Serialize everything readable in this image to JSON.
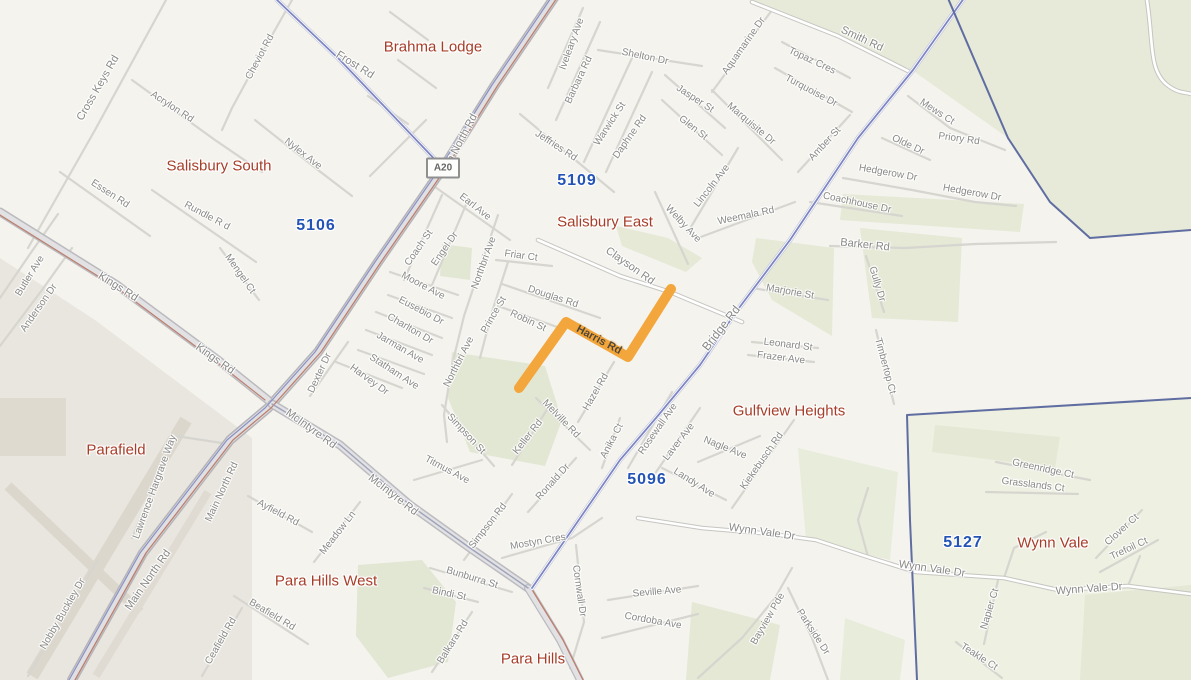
{
  "map": {
    "road_shield": {
      "label": "A20"
    },
    "route_highlight": {
      "name": "Harris Rd",
      "color": "#F3A63B"
    },
    "colors": {
      "background_urban": "#f4f3ee",
      "terrain_green": "#e7ead9",
      "airport_grey": "#e9e6df",
      "arterial_blue": "#7d86c2",
      "boundary_navy": "#5f6da1",
      "suburb_text": "#a63d28",
      "postcode_text": "#2353b5",
      "street_text": "#898987"
    },
    "suburb_labels": [
      {
        "t": "Brahma Lodge",
        "x": 433,
        "y": 47
      },
      {
        "t": "Salisbury South",
        "x": 219,
        "y": 166
      },
      {
        "t": "Salisbury East",
        "x": 605,
        "y": 222
      },
      {
        "t": "Parafield",
        "x": 116,
        "y": 450
      },
      {
        "t": "Para Hills West",
        "x": 326,
        "y": 581
      },
      {
        "t": "Para Hills",
        "x": 533,
        "y": 659
      },
      {
        "t": "Gulfview Heights",
        "x": 789,
        "y": 411
      },
      {
        "t": "Wynn Vale",
        "x": 1053,
        "y": 543
      }
    ],
    "postcode_labels": [
      {
        "t": "5106",
        "x": 316,
        "y": 226
      },
      {
        "t": "5109",
        "x": 577,
        "y": 181
      },
      {
        "t": "5096",
        "x": 647,
        "y": 480
      },
      {
        "t": "5127",
        "x": 963,
        "y": 543
      }
    ],
    "street_labels": [
      {
        "t": "Cross Keys Rd",
        "x": 98,
        "y": 88,
        "r": -60,
        "s": 11
      },
      {
        "t": "Acrylon Rd",
        "x": 172,
        "y": 107,
        "r": 33
      },
      {
        "t": "Cheviot Rd",
        "x": 260,
        "y": 57,
        "r": -62
      },
      {
        "t": "Frost Rd",
        "x": 355,
        "y": 65,
        "r": 32,
        "s": 11
      },
      {
        "t": "Nylex Ave",
        "x": 303,
        "y": 154,
        "r": 38
      },
      {
        "t": "Essen Rd",
        "x": 110,
        "y": 194,
        "r": 33
      },
      {
        "t": "Rundle R d",
        "x": 207,
        "y": 216,
        "r": 28
      },
      {
        "t": "Butler Ave",
        "x": 30,
        "y": 276,
        "r": -58
      },
      {
        "t": "Anderson Dr",
        "x": 39,
        "y": 308,
        "r": -55
      },
      {
        "t": "Kings Rd",
        "x": 118,
        "y": 287,
        "r": 32,
        "s": 11
      },
      {
        "t": "Kings Rd",
        "x": 215,
        "y": 359,
        "r": 35,
        "s": 11
      },
      {
        "t": "Mengel Ct",
        "x": 240,
        "y": 274,
        "r": 55
      },
      {
        "t": "Main North Rd",
        "x": 458,
        "y": 146,
        "r": -62,
        "s": 11
      },
      {
        "t": "Main North Rd",
        "x": 222,
        "y": 492,
        "r": -65
      },
      {
        "t": "Main North Rd",
        "x": 148,
        "y": 580,
        "r": -55,
        "s": 11
      },
      {
        "t": "Iveleary Ave",
        "x": 572,
        "y": 44,
        "r": -70
      },
      {
        "t": "Barbara Rd",
        "x": 579,
        "y": 80,
        "r": -65
      },
      {
        "t": "Jeffries Rd",
        "x": 556,
        "y": 146,
        "r": 33
      },
      {
        "t": "Warwick St",
        "x": 610,
        "y": 124,
        "r": -57
      },
      {
        "t": "Daphne Rd",
        "x": 630,
        "y": 137,
        "r": -55
      },
      {
        "t": "Shelton Dr",
        "x": 645,
        "y": 57,
        "r": 12
      },
      {
        "t": "Jasper St",
        "x": 695,
        "y": 99,
        "r": 33
      },
      {
        "t": "Glen St",
        "x": 693,
        "y": 128,
        "r": 38
      },
      {
        "t": "Aquamarine Dr",
        "x": 744,
        "y": 46,
        "r": -55
      },
      {
        "t": "Topaz Cres",
        "x": 812,
        "y": 61,
        "r": 25
      },
      {
        "t": "Turquoise Dr",
        "x": 811,
        "y": 91,
        "r": 28
      },
      {
        "t": "Marquisite Dr",
        "x": 751,
        "y": 124,
        "r": 40
      },
      {
        "t": "Amber St",
        "x": 825,
        "y": 144,
        "r": -47
      },
      {
        "t": "Lincoln Ave",
        "x": 712,
        "y": 186,
        "r": -52
      },
      {
        "t": "Welby Ave",
        "x": 683,
        "y": 224,
        "r": 47
      },
      {
        "t": "Weemala Rd",
        "x": 746,
        "y": 216,
        "r": -12
      },
      {
        "t": "Smith Rd",
        "x": 862,
        "y": 39,
        "r": 25,
        "s": 11
      },
      {
        "t": "Mews Ct",
        "x": 937,
        "y": 112,
        "r": 33
      },
      {
        "t": "Priory Rd",
        "x": 959,
        "y": 139,
        "r": 8
      },
      {
        "t": "Olde Dr",
        "x": 908,
        "y": 145,
        "r": 25
      },
      {
        "t": "Hedgerow Dr",
        "x": 888,
        "y": 173,
        "r": 10
      },
      {
        "t": "Hedgerow Dr",
        "x": 972,
        "y": 193,
        "r": 10
      },
      {
        "t": "Coachhouse Dr",
        "x": 857,
        "y": 203,
        "r": 12
      },
      {
        "t": "Barker Rd",
        "x": 865,
        "y": 245,
        "r": 6,
        "s": 11
      },
      {
        "t": "Gully Dr",
        "x": 877,
        "y": 284,
        "r": 73
      },
      {
        "t": "Marjorie St",
        "x": 790,
        "y": 292,
        "r": 10
      },
      {
        "t": "Leonard St",
        "x": 788,
        "y": 345,
        "r": 7
      },
      {
        "t": "Frazer Ave",
        "x": 781,
        "y": 358,
        "r": 7
      },
      {
        "t": "Timbertop Ct",
        "x": 885,
        "y": 366,
        "r": 75
      },
      {
        "t": "Bridge Rd",
        "x": 721,
        "y": 328,
        "r": -52,
        "s": 12
      },
      {
        "t": "Earl Ave",
        "x": 475,
        "y": 207,
        "r": 38
      },
      {
        "t": "Coach St",
        "x": 419,
        "y": 248,
        "r": -55
      },
      {
        "t": "Engel Dr",
        "x": 445,
        "y": 249,
        "r": -55
      },
      {
        "t": "Northbri Ave",
        "x": 484,
        "y": 263,
        "r": -70
      },
      {
        "t": "Northbri Ave",
        "x": 459,
        "y": 362,
        "r": -63
      },
      {
        "t": "Moore Ave",
        "x": 423,
        "y": 286,
        "r": 28
      },
      {
        "t": "Eusebio Dr",
        "x": 421,
        "y": 311,
        "r": 28
      },
      {
        "t": "Charlton Dr",
        "x": 410,
        "y": 329,
        "r": 30
      },
      {
        "t": "Jarman Ave",
        "x": 400,
        "y": 348,
        "r": 30
      },
      {
        "t": "Statham Ave",
        "x": 394,
        "y": 372,
        "r": 33
      },
      {
        "t": "Harvey Dr",
        "x": 369,
        "y": 380,
        "r": 36
      },
      {
        "t": "Dexter Dr",
        "x": 320,
        "y": 373,
        "r": -65
      },
      {
        "t": "Prince St",
        "x": 494,
        "y": 315,
        "r": -60
      },
      {
        "t": "Robin St",
        "x": 528,
        "y": 321,
        "r": 25
      },
      {
        "t": "Friar Ct",
        "x": 521,
        "y": 256,
        "r": 8
      },
      {
        "t": "Douglas Rd",
        "x": 553,
        "y": 297,
        "r": 18
      },
      {
        "t": "Clayson Rd",
        "x": 630,
        "y": 266,
        "r": 35,
        "s": 11
      },
      {
        "t": "Harris Rd",
        "x": 599,
        "y": 340,
        "r": 28,
        "s": 11,
        "c": "on-route"
      },
      {
        "t": "Melville Rd",
        "x": 561,
        "y": 419,
        "r": 46
      },
      {
        "t": "Keller Rd",
        "x": 528,
        "y": 437,
        "r": -52
      },
      {
        "t": "Hazel Rd",
        "x": 596,
        "y": 392,
        "r": -60
      },
      {
        "t": "Simpson St",
        "x": 466,
        "y": 434,
        "r": 47
      },
      {
        "t": "Titmus Ave",
        "x": 447,
        "y": 470,
        "r": 28
      },
      {
        "t": "Simpson Rd",
        "x": 488,
        "y": 526,
        "r": -52
      },
      {
        "t": "Ronald Dr",
        "x": 553,
        "y": 482,
        "r": -48
      },
      {
        "t": "Mostyn Cres",
        "x": 538,
        "y": 542,
        "r": -10
      },
      {
        "t": "Anika Ct",
        "x": 612,
        "y": 441,
        "r": -62
      },
      {
        "t": "Cornwall Dr",
        "x": 579,
        "y": 591,
        "r": 82
      },
      {
        "t": "McIntyre Rd",
        "x": 311,
        "y": 429,
        "r": 36,
        "s": 11
      },
      {
        "t": "McIntyre Rd",
        "x": 393,
        "y": 495,
        "r": 38,
        "s": 11
      },
      {
        "t": "Ayfield Rd",
        "x": 278,
        "y": 513,
        "r": 28
      },
      {
        "t": "Meadow Ln",
        "x": 338,
        "y": 533,
        "r": -52
      },
      {
        "t": "Beafield Rd",
        "x": 272,
        "y": 615,
        "r": 31
      },
      {
        "t": "Ceafield Rd",
        "x": 221,
        "y": 641,
        "r": -60
      },
      {
        "t": "Balkara Rd",
        "x": 453,
        "y": 642,
        "r": -58
      },
      {
        "t": "Bunburra St",
        "x": 472,
        "y": 578,
        "r": 17
      },
      {
        "t": "Bindi St",
        "x": 449,
        "y": 594,
        "r": 12
      },
      {
        "t": "Bayview Pde",
        "x": 768,
        "y": 619,
        "r": -60
      },
      {
        "t": "Parkside Dr",
        "x": 813,
        "y": 632,
        "r": 57
      },
      {
        "t": "Seville Ave",
        "x": 657,
        "y": 592,
        "r": -5
      },
      {
        "t": "Cordoba Ave",
        "x": 653,
        "y": 621,
        "r": 10
      },
      {
        "t": "Rosewall Ave",
        "x": 658,
        "y": 429,
        "r": -55
      },
      {
        "t": "Laver Ave",
        "x": 679,
        "y": 442,
        "r": -52
      },
      {
        "t": "Landy Ave",
        "x": 694,
        "y": 483,
        "r": 32
      },
      {
        "t": "Nagle Ave",
        "x": 725,
        "y": 448,
        "r": 22
      },
      {
        "t": "Kiekebusch Rd",
        "x": 762,
        "y": 461,
        "r": -55
      },
      {
        "t": "Wynn Vale Dr",
        "x": 762,
        "y": 532,
        "r": 8,
        "s": 11
      },
      {
        "t": "Wynn Vale Dr",
        "x": 932,
        "y": 569,
        "r": 8,
        "s": 11
      },
      {
        "t": "Wynn Vale Dr",
        "x": 1089,
        "y": 589,
        "r": -4,
        "s": 11
      },
      {
        "t": "Greenridge Ct",
        "x": 1043,
        "y": 469,
        "r": 12
      },
      {
        "t": "Grasslands Ct",
        "x": 1033,
        "y": 485,
        "r": 7
      },
      {
        "t": "Clover Ct",
        "x": 1122,
        "y": 530,
        "r": -42
      },
      {
        "t": "Trefoil Ct",
        "x": 1129,
        "y": 549,
        "r": -25
      },
      {
        "t": "Napier Ct",
        "x": 990,
        "y": 609,
        "r": -73
      },
      {
        "t": "Teakle Ct",
        "x": 979,
        "y": 657,
        "r": 33
      },
      {
        "t": "Nobby Buckley Dr",
        "x": 63,
        "y": 614,
        "r": -60
      },
      {
        "t": "Lawrence Hargrave Way",
        "x": 155,
        "y": 487,
        "r": -70
      }
    ]
  }
}
